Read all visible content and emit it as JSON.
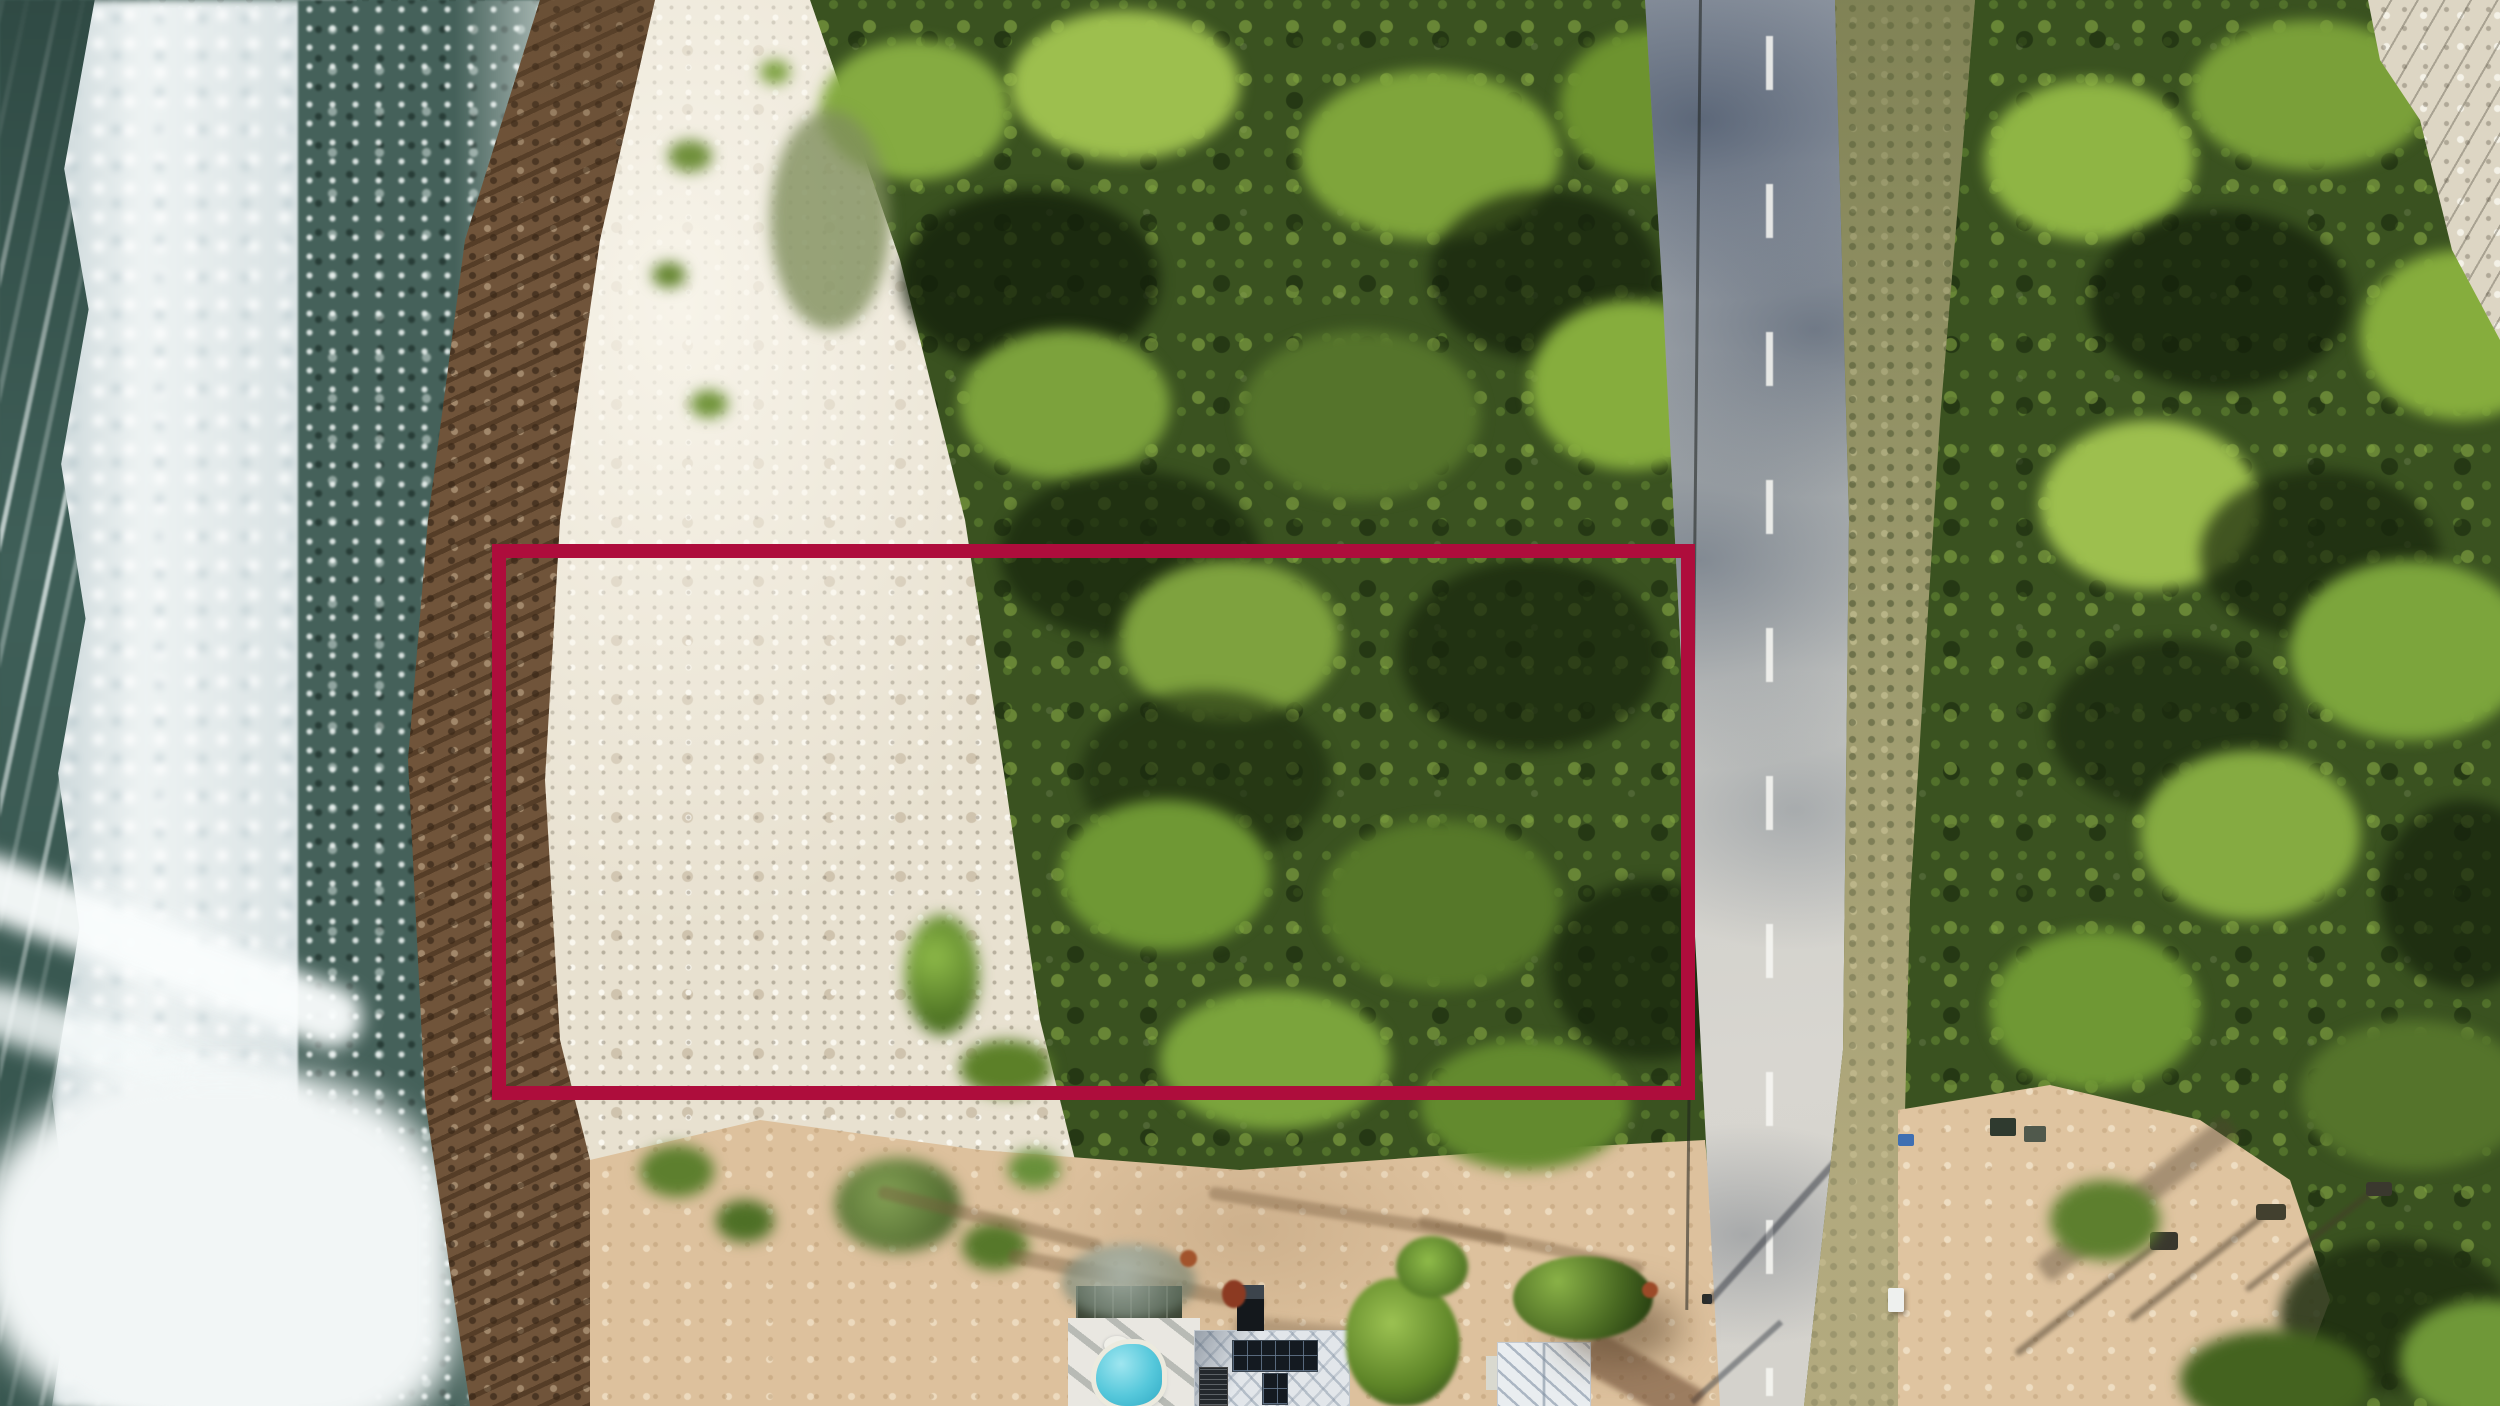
{
  "scene": {
    "description": "Aerial drone photograph of an oceanfront land parcel outlined in red, between a rocky beach and a coastal road, with dense green vegetation and beach houses below",
    "ocean_color": "#4a675f",
    "surf_color": "#eef3f3",
    "foam_lace_color": "#45615a",
    "reef_rock_color": "#70543a",
    "beach_color": "#e8e1d0",
    "sand_color": "#ddc19d",
    "canopy_color": "#3a5220",
    "canopy_highlight_color": "#8fb544",
    "road_color": "#cfcfca",
    "road_shadow_color": "#55708c",
    "scrub_color": "#9c9a6d",
    "limestone_color": "#ddd6c4",
    "pool_color": "#56c8db",
    "roof_color": "#e9edf0",
    "solar_panel_color": "#141a21"
  },
  "parcel_boundary": {
    "left": "492px",
    "top": "544px",
    "width": "1203px",
    "height": "556px",
    "border_width": "14px",
    "color": "#ae0d3c"
  }
}
